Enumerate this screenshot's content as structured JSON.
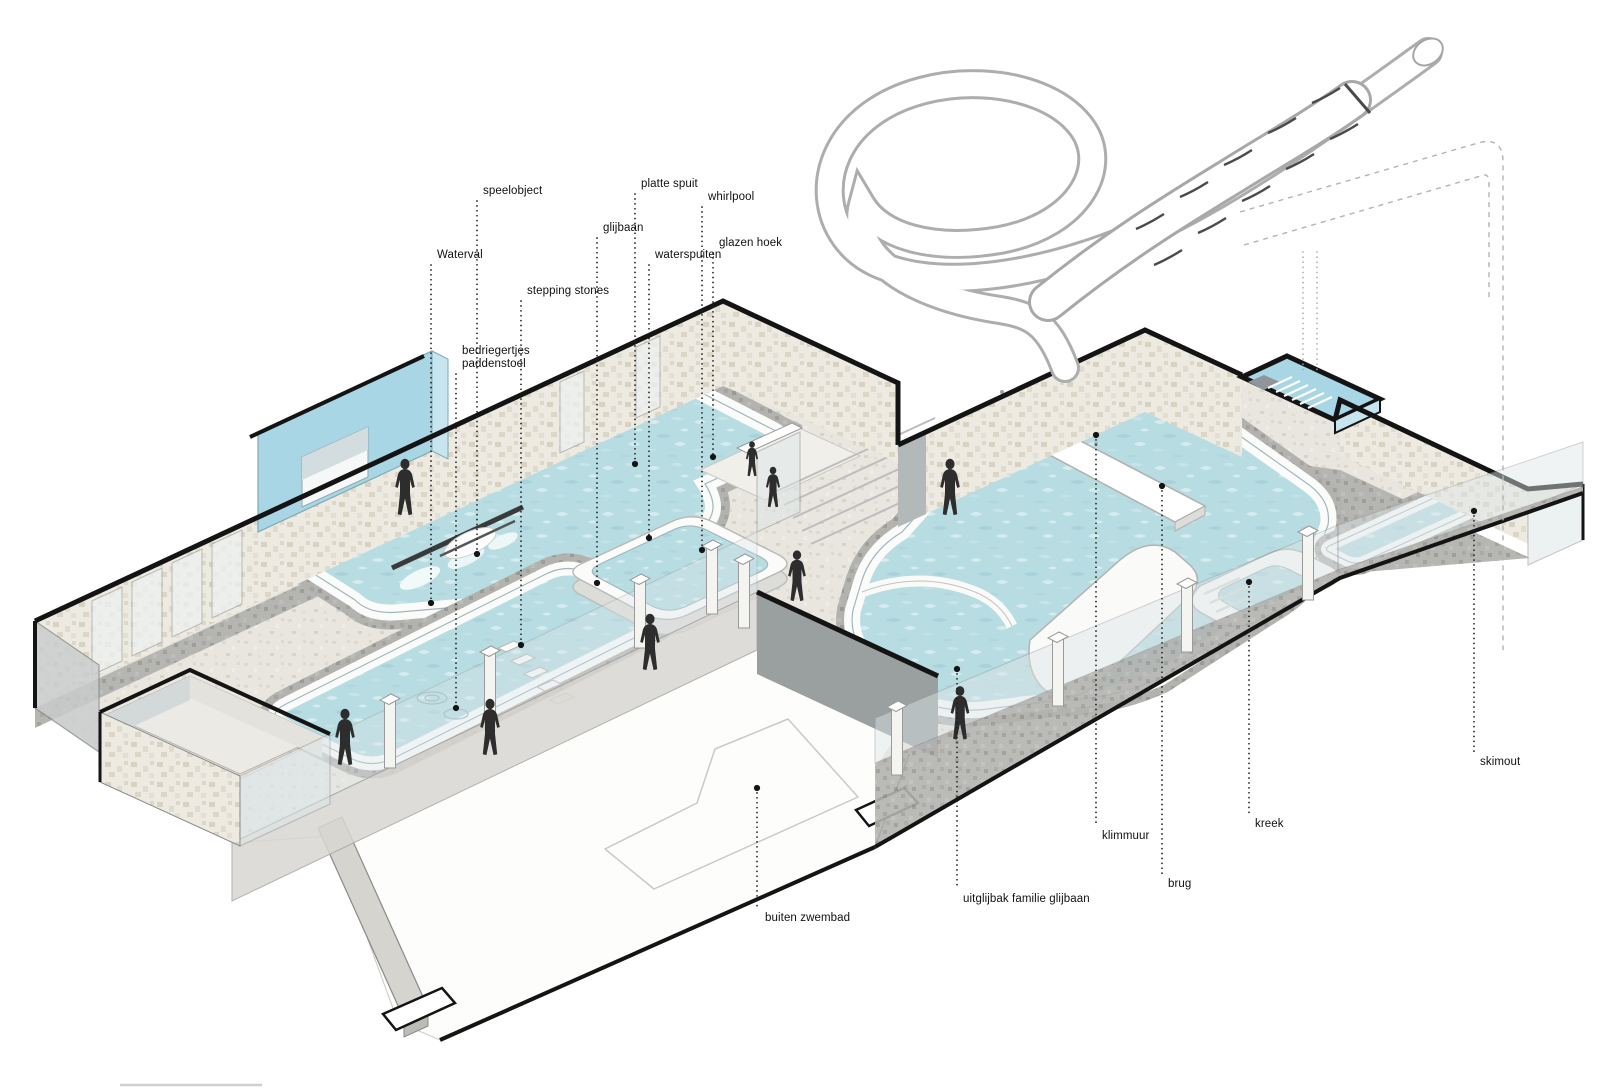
{
  "page": {
    "title": "Zwembad axonometrie - overzicht speelelementen",
    "type": "axonometric architectural cutaway diagram of an indoor/outdoor swimming pool complex"
  },
  "colors": {
    "background": "#ffffff",
    "water_base": "#b7dce2",
    "water_ripple_light": "#dceff1",
    "water_ripple_dark": "#a4ced7",
    "pool_rim": "#fbfbfa",
    "deck_base": "#e9e6df",
    "deck_speckle": "#d9d4c8",
    "stone_base": "#edeae2",
    "stone_speckle": "#d8d2c2",
    "gray_tile_base": "#b2b2af",
    "gray_tile_speckle": "#a09e99",
    "blue_tile": "#a9d6e4",
    "blue_tile_light": "#c6e5ee",
    "wall_dark": "#9aa0a0",
    "glass": "#dde6e8",
    "outline_black": "#141414",
    "outline_gray": "#9a9a9a",
    "figure": "#2d2d2d",
    "label_text": "#111111",
    "leader": "#1c1c1c",
    "dashed_guide": "#b3b3b3"
  },
  "figures": {
    "count": 9,
    "style": "black silhouettes of swimmers and visitors"
  },
  "annotations": [
    {
      "id": "speelobject",
      "lines": [
        "speelobject"
      ],
      "lx": 483,
      "ly": 185,
      "x": 477,
      "y_label": 201,
      "y_dot": 554
    },
    {
      "id": "platte-spuit",
      "lines": [
        "platte spuit"
      ],
      "lx": 641,
      "ly": 178,
      "x": 635,
      "y_label": 194,
      "y_dot": 464
    },
    {
      "id": "whirlpool",
      "lines": [
        "whirlpool"
      ],
      "lx": 708,
      "ly": 191,
      "x": 702,
      "y_label": 207,
      "y_dot": 550
    },
    {
      "id": "glijbaan",
      "lines": [
        "glijbaan"
      ],
      "lx": 603,
      "ly": 222,
      "x": 597,
      "y_label": 238,
      "y_dot": 583
    },
    {
      "id": "glazen-hoek",
      "lines": [
        "glazen hoek"
      ],
      "lx": 719,
      "ly": 237,
      "x": 713,
      "y_label": 253,
      "y_dot": 457
    },
    {
      "id": "waterval",
      "lines": [
        "Waterval"
      ],
      "lx": 437,
      "ly": 249,
      "x": 431,
      "y_label": 265,
      "y_dot": 603
    },
    {
      "id": "waterspuiten",
      "lines": [
        "waterspuiten"
      ],
      "lx": 655,
      "ly": 249,
      "x": 649,
      "y_label": 265,
      "y_dot": 538
    },
    {
      "id": "stepping-stones",
      "lines": [
        "stepping stones"
      ],
      "lx": 527,
      "ly": 285,
      "x": 521,
      "y_label": 301,
      "y_dot": 645
    },
    {
      "id": "bedriegertjes-paddenstoel",
      "lines": [
        "bedriegertjes",
        "paddenstoel"
      ],
      "lx": 462,
      "ly": 345,
      "x": 456,
      "y_label": 374,
      "y_dot": 708
    },
    {
      "id": "buiten-zwembad",
      "lines": [
        "buiten zwembad"
      ],
      "lx": 765,
      "ly": 912,
      "x": 757,
      "y_label": 908,
      "y_dot": 788
    },
    {
      "id": "uitglijbak-familie-glijbaan",
      "lines": [
        "uitglijbak familie glijbaan"
      ],
      "lx": 963,
      "ly": 893,
      "x": 957,
      "y_label": 889,
      "y_dot": 669
    },
    {
      "id": "klimmuur",
      "lines": [
        "klimmuur"
      ],
      "lx": 1102,
      "ly": 830,
      "x": 1096,
      "y_label": 826,
      "y_dot": 435
    },
    {
      "id": "brug",
      "lines": [
        "brug"
      ],
      "lx": 1168,
      "ly": 878,
      "x": 1162,
      "y_label": 874,
      "y_dot": 486
    },
    {
      "id": "kreek",
      "lines": [
        "kreek"
      ],
      "lx": 1255,
      "ly": 818,
      "x": 1249,
      "y_label": 814,
      "y_dot": 582
    },
    {
      "id": "skimout",
      "lines": [
        "skimout"
      ],
      "lx": 1480,
      "ly": 756,
      "x": 1474,
      "y_label": 752,
      "y_dot": 511
    }
  ]
}
